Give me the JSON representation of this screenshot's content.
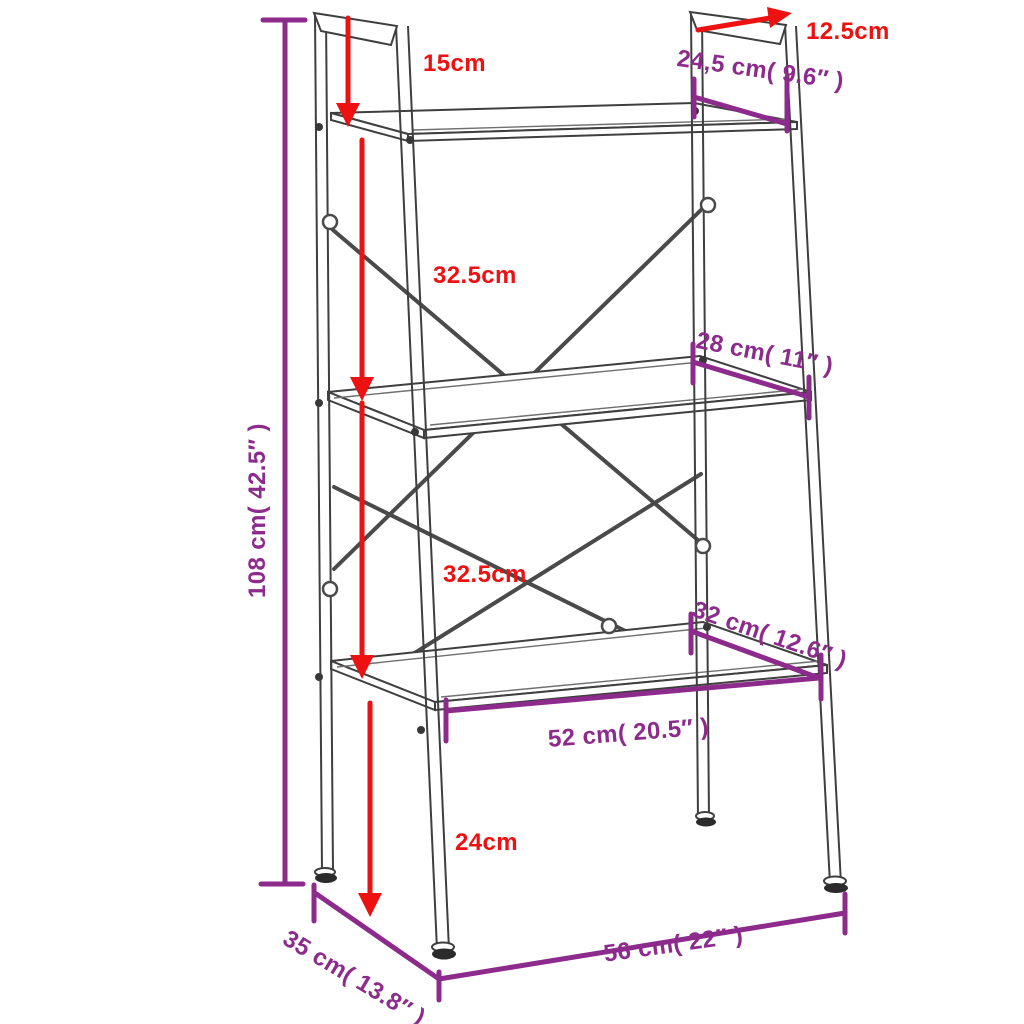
{
  "diagram": {
    "title": "3-tier ladder shelf dimension diagram",
    "colors": {
      "red": "#ee1111",
      "purple": "#8c2b8c",
      "frame": "#3f3f3f"
    },
    "labels": {
      "top_gap": "15cm",
      "top_offset": "12.5cm",
      "top_shelf_depth": "24,5 cm( 9.6″ )",
      "upper_shelf_gap": "32.5cm",
      "middle_shelf_depth": "28 cm( 11″ )",
      "lower_shelf_gap": "32.5cm",
      "bottom_shelf_depth": "32 cm( 12.6″ )",
      "bottom_shelf_width": "52 cm( 20.5″ )",
      "leg_clearance": "24cm",
      "overall_height": "108 cm( 42.5″ )",
      "base_depth": "35 cm( 13.8″ )",
      "base_width": "56 cm( 22″ )"
    }
  }
}
